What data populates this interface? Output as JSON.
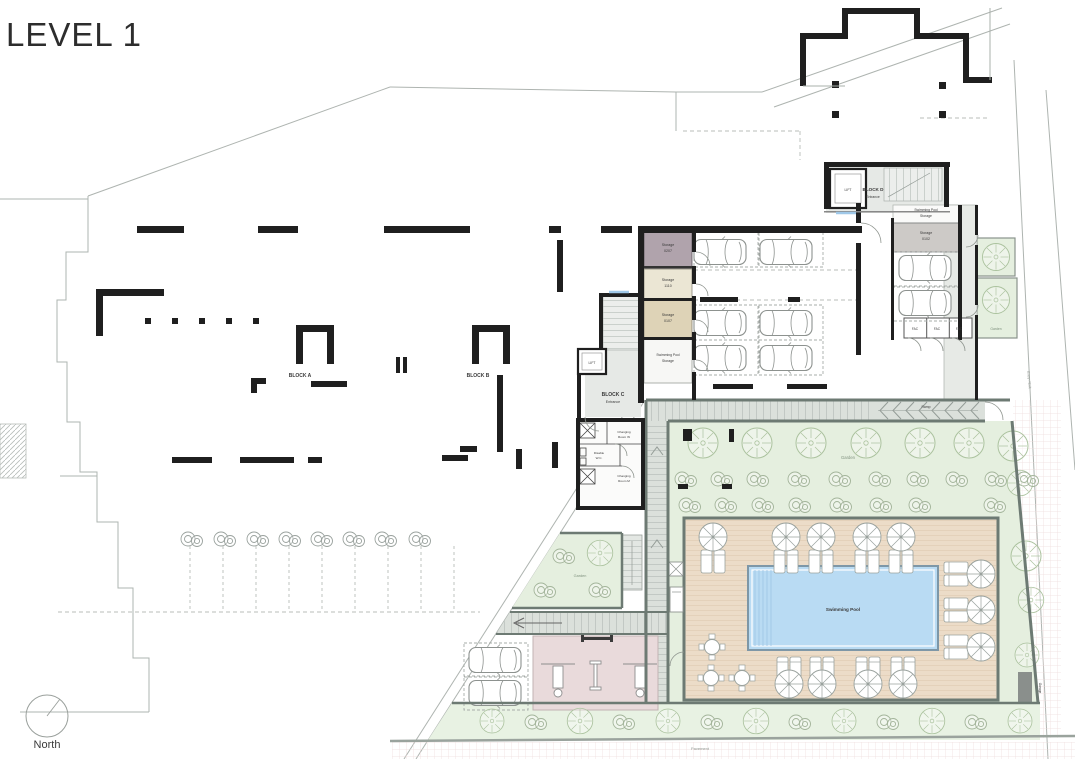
{
  "title": "LEVEL 1",
  "compass": {
    "label": "North"
  },
  "blocks": {
    "a": {
      "label": "BLOCK A"
    },
    "b": {
      "label": "BLOCK B"
    },
    "c": {
      "label": "BLOCK C",
      "sublabel": "Entrance"
    },
    "d": {
      "label": "BLOCK D",
      "sublabel": "Entrance"
    }
  },
  "lifts": {
    "c": "LIFT",
    "d": "LIFT"
  },
  "storages": {
    "s1": {
      "name": "Storage",
      "number": "0207"
    },
    "s2": {
      "name": "Storage",
      "number": "1110"
    },
    "s3": {
      "name": "Storage",
      "number": "0107"
    },
    "d": {
      "name": "Storage",
      "number": "0102"
    },
    "pool_c": {
      "line1": "Swimming Pool",
      "line2": "Storage"
    },
    "pool_d": {
      "line1": "Swimming Pool",
      "line2": "Storage"
    }
  },
  "facilities": {
    "fac1": "FAC",
    "fac2": "FAC",
    "fac3": "FAC"
  },
  "changing": {
    "w": {
      "line1": "Changing",
      "line2": "Room W"
    },
    "wc": {
      "line1": "Disable",
      "line2": "W.C."
    },
    "m": {
      "line1": "Changing",
      "line2": "Room M"
    }
  },
  "outdoor": {
    "garden_main": "Garden",
    "garden_terrace": "Garden",
    "garden_side": "Garden",
    "swimming_pool": "Swimming Pool",
    "ramp": "Ramp",
    "pavement": "Pavement",
    "entry_exit": "Entry / Exit",
    "garage": "Garage"
  },
  "colors": {
    "wall": "#1f1f1f",
    "garden": "#e5efdf",
    "deck": "#ecdcc8",
    "pool": "#b9dbf3",
    "walkway": "#dbe0db",
    "gym": "#e9dadb",
    "storage_mauve": "#b0a3ac",
    "storage_cream": "#ebe6d4",
    "storage_tan": "#ded3b7",
    "garden_wall": "#6d7a73"
  }
}
